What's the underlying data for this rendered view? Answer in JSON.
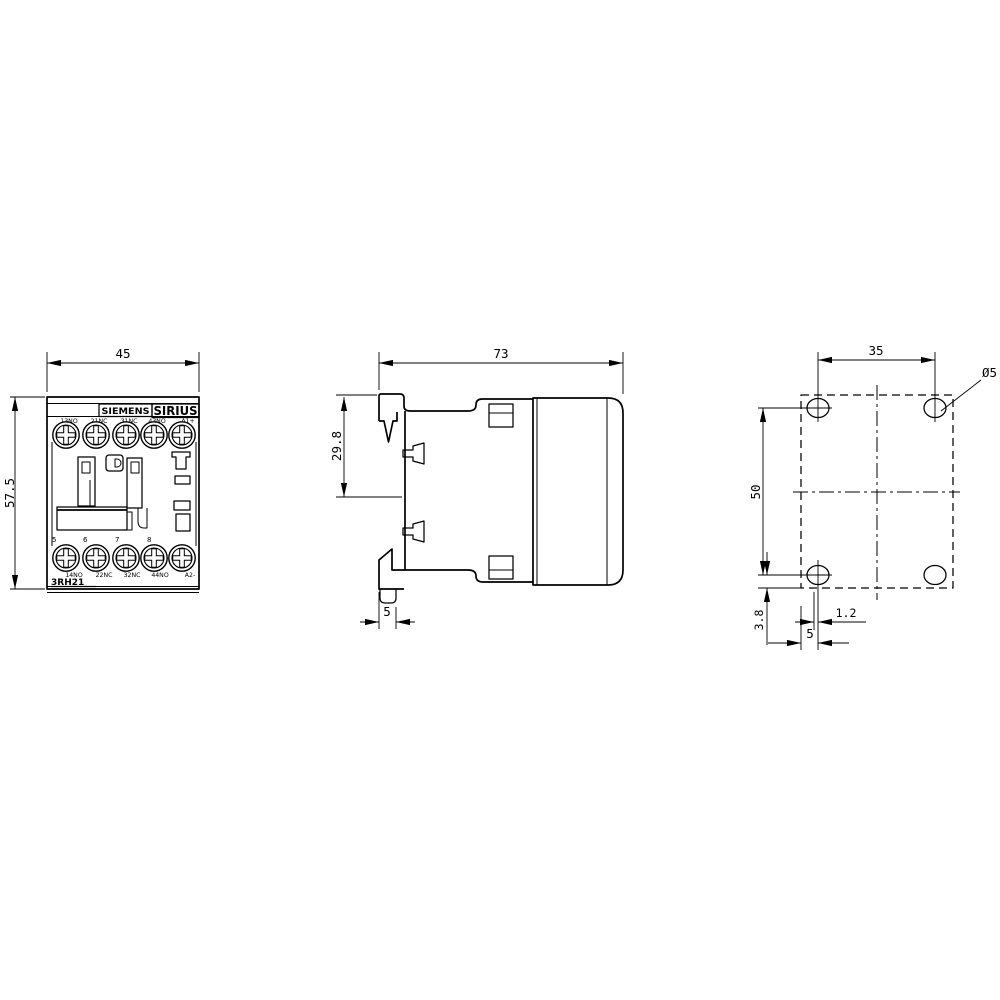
{
  "drawing": {
    "brand": "SIEMENS",
    "series": "SIRIUS",
    "model": "3RH21"
  },
  "front_view": {
    "width_dim": "45",
    "height_dim": "57.5",
    "top_terminal_labels": [
      "13NO",
      "21NC",
      "31NC",
      "43NO",
      "A1+"
    ],
    "bottom_terminal_numbers": [
      "5",
      "6",
      "7",
      "8"
    ],
    "bottom_terminal_labels": [
      "14NO",
      "22NC",
      "32NC",
      "44NO",
      "A2-"
    ]
  },
  "side_view": {
    "depth_dim": "73",
    "din_rail_dim": "29.8",
    "foot_width_dim": "5"
  },
  "drill_pattern_view": {
    "hole_spacing_horizontal": "35",
    "hole_spacing_vertical": "50",
    "hole_diameter": "Ø5",
    "offset_dim": "3.8",
    "slot_dim": "1.2",
    "clip_width_dim": "5"
  }
}
